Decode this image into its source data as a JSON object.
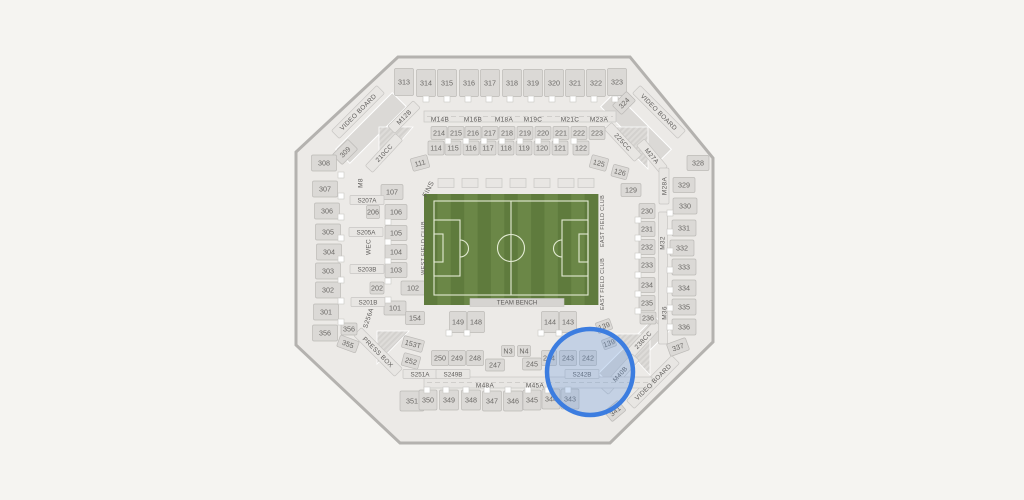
{
  "page": {
    "background": "#f5f4f1"
  },
  "stadium": {
    "octagon": "398,57 630,57 713,158 713,342 610,443 400,443 296,345 296,152",
    "colors": {
      "concourse": "#eceae7",
      "outline": "#b4b2af",
      "section": "#dbd9d6",
      "sectionStroke": "#bcbab7",
      "strip": "#e8e6e3",
      "stripStroke": "#c8c6c3",
      "label": "#6b6966",
      "stripLabel": "#5f5d5b",
      "marker": "#ffffff",
      "markerStroke": "#c9c7c4",
      "fieldLight": "#6b8747",
      "fieldDark": "#5f7b3d",
      "fieldLine": "#e3ebd3",
      "bench": "#d6d4d1",
      "ringBlue": "#3c7de0",
      "overlayBlue": "rgba(104,153,222,0.30)"
    },
    "field": {
      "x": 424,
      "y": 194,
      "w": 174,
      "h": 111,
      "stripes": 13,
      "bench_label": "TEAM BENCH",
      "bench": [
        470,
        298.5,
        94,
        8
      ]
    },
    "decor_bands": [
      [
        371,
        128,
        80,
        20,
        -45
      ],
      [
        636,
        128,
        80,
        20,
        45
      ],
      [
        634,
        352,
        80,
        20,
        -45
      ]
    ],
    "hatches": [
      "379,127 413,127 379,166",
      "606,127 648,127 648,169",
      "612,334 650,334 650,375",
      "377,331 409,331 377,364"
    ],
    "rot_bands": [
      [
        358,
        112,
        64,
        11,
        -45
      ],
      [
        659,
        112,
        64,
        11,
        45
      ],
      [
        653,
        382,
        64,
        11,
        -45
      ],
      [
        378,
        352,
        58,
        11,
        45
      ],
      [
        384,
        153,
        44,
        10,
        -47
      ],
      [
        623,
        142,
        44,
        10,
        47
      ],
      [
        643,
        340,
        44,
        10,
        -47
      ],
      [
        652,
        156,
        36,
        10,
        50
      ],
      [
        620,
        374,
        46,
        10,
        -48
      ],
      [
        404,
        117,
        36,
        10,
        -45
      ],
      [
        664,
        186,
        10,
        36,
        0
      ],
      [
        663,
        278,
        9,
        132,
        0
      ]
    ],
    "h_bands": [
      [
        424,
        111,
        192,
        11
      ],
      [
        424,
        377,
        228,
        11
      ]
    ],
    "suites": {
      "y": 183,
      "w": 16,
      "h": 9,
      "xs": [
        446,
        470,
        494,
        518,
        542,
        566,
        586
      ]
    },
    "sections": [
      [
        "313",
        404,
        82,
        19,
        27
      ],
      [
        "314",
        426,
        83,
        19,
        27
      ],
      [
        "315",
        447,
        83,
        19,
        27
      ],
      [
        "316",
        469,
        83,
        19,
        27
      ],
      [
        "317",
        490,
        83,
        19,
        27
      ],
      [
        "318",
        512,
        83,
        19,
        27
      ],
      [
        "319",
        533,
        83,
        19,
        27
      ],
      [
        "320",
        554,
        83,
        19,
        27
      ],
      [
        "321",
        575,
        83,
        19,
        27
      ],
      [
        "322",
        596,
        83,
        19,
        27
      ],
      [
        "323",
        617,
        82,
        19,
        27
      ],
      [
        "324",
        624,
        103,
        20,
        13,
        -45
      ],
      [
        "214",
        439,
        133,
        16,
        13
      ],
      [
        "215",
        456,
        133,
        16,
        13
      ],
      [
        "216",
        473,
        133,
        16,
        13
      ],
      [
        "217",
        490,
        133,
        16,
        13
      ],
      [
        "218",
        507,
        133,
        16,
        13
      ],
      [
        "219",
        525,
        133,
        16,
        13
      ],
      [
        "220",
        543,
        133,
        16,
        13
      ],
      [
        "221",
        561,
        133,
        16,
        13
      ],
      [
        "222",
        579,
        133,
        16,
        13
      ],
      [
        "223",
        597,
        133,
        16,
        13
      ],
      [
        "114",
        436,
        148,
        16,
        14
      ],
      [
        "115",
        453,
        148,
        16,
        14
      ],
      [
        "116",
        471,
        148,
        16,
        14
      ],
      [
        "117",
        488,
        148,
        16,
        14
      ],
      [
        "118",
        506,
        148,
        16,
        14
      ],
      [
        "119",
        524,
        148,
        16,
        14
      ],
      [
        "120",
        542,
        148,
        16,
        14
      ],
      [
        "121",
        560,
        148,
        16,
        14
      ],
      [
        "122",
        581,
        148,
        16,
        14
      ],
      [
        "111",
        420,
        163,
        17,
        13,
        -15
      ],
      [
        "125",
        599,
        163,
        17,
        13,
        15
      ],
      [
        "126",
        620,
        172,
        16,
        12,
        15
      ],
      [
        "129",
        631,
        190,
        20,
        13
      ],
      [
        "309",
        345,
        152,
        22,
        14,
        -45
      ],
      [
        "308",
        324,
        163,
        25,
        16
      ],
      [
        "307",
        325,
        189,
        25,
        16
      ],
      [
        "306",
        327,
        211,
        25,
        16
      ],
      [
        "305",
        328,
        232,
        25,
        16
      ],
      [
        "304",
        329,
        252,
        25,
        16
      ],
      [
        "303",
        328,
        271,
        25,
        16
      ],
      [
        "302",
        328,
        290,
        25,
        16
      ],
      [
        "301",
        326,
        312,
        25,
        16
      ],
      [
        "356",
        325,
        333,
        25,
        16
      ],
      [
        "356",
        349,
        329,
        16,
        12
      ],
      [
        "355",
        348,
        344,
        20,
        12,
        20
      ],
      [
        "107",
        392,
        192,
        22,
        15
      ],
      [
        "106",
        396,
        212,
        22,
        15
      ],
      [
        "105",
        396,
        233,
        22,
        15
      ],
      [
        "104",
        396,
        252,
        22,
        15
      ],
      [
        "103",
        396,
        270,
        22,
        15
      ],
      [
        "102",
        413,
        288,
        24,
        14
      ],
      [
        "101",
        395,
        308,
        22,
        14
      ],
      [
        "206",
        373,
        212,
        13,
        13
      ],
      [
        "202",
        377,
        288,
        14,
        12
      ],
      [
        "154",
        415,
        318,
        19,
        13
      ],
      [
        "153T",
        413,
        344,
        21,
        12,
        15
      ],
      [
        "149",
        458,
        322,
        17,
        21
      ],
      [
        "148",
        476,
        322,
        17,
        21
      ],
      [
        "144",
        550,
        322,
        17,
        21
      ],
      [
        "143",
        568,
        322,
        17,
        21
      ],
      [
        "139",
        604,
        326,
        15,
        11,
        -20
      ],
      [
        "139",
        609,
        343,
        13,
        10,
        -20
      ],
      [
        "252",
        411,
        361,
        17,
        13,
        15
      ],
      [
        "250",
        440,
        358,
        17,
        15
      ],
      [
        "249",
        457,
        358,
        17,
        15
      ],
      [
        "248",
        475,
        358,
        17,
        15
      ],
      [
        "247",
        495,
        365,
        19,
        12
      ],
      [
        "245",
        532,
        364,
        19,
        12
      ],
      [
        "244",
        549,
        358,
        15,
        15
      ],
      [
        "243",
        568,
        358,
        17,
        15
      ],
      [
        "242",
        588,
        358,
        17,
        15
      ],
      [
        "N3",
        508,
        351,
        13,
        11
      ],
      [
        "N4",
        524,
        351,
        13,
        11
      ],
      [
        "351",
        412,
        401,
        24,
        20
      ],
      [
        "350",
        428,
        400,
        18,
        20
      ],
      [
        "349",
        449,
        400,
        19,
        20
      ],
      [
        "348",
        471,
        400,
        19,
        20
      ],
      [
        "347",
        492,
        401,
        19,
        20
      ],
      [
        "346",
        513,
        401,
        19,
        20
      ],
      [
        "345",
        532,
        400,
        18,
        20
      ],
      [
        "344",
        551,
        399,
        18,
        20
      ],
      [
        "343",
        570,
        399,
        18,
        20
      ],
      [
        "341",
        615,
        411,
        18,
        13,
        -40
      ],
      [
        "328",
        698,
        163,
        22,
        15
      ],
      [
        "329",
        684,
        185,
        22,
        15
      ],
      [
        "330",
        685,
        206,
        24,
        16
      ],
      [
        "331",
        684,
        228,
        24,
        16
      ],
      [
        "332",
        682,
        248,
        24,
        16
      ],
      [
        "333",
        684,
        267,
        24,
        16
      ],
      [
        "334",
        684,
        288,
        24,
        16
      ],
      [
        "335",
        684,
        307,
        24,
        16
      ],
      [
        "336",
        684,
        327,
        24,
        16
      ],
      [
        "337",
        678,
        347,
        20,
        13,
        -20
      ],
      [
        "230",
        647,
        211,
        16,
        15
      ],
      [
        "231",
        647,
        229,
        16,
        15
      ],
      [
        "232",
        647,
        247,
        16,
        15
      ],
      [
        "233",
        647,
        265,
        16,
        15
      ],
      [
        "234",
        647,
        285,
        16,
        15
      ],
      [
        "235",
        647,
        303,
        16,
        15
      ],
      [
        "236",
        648,
        318,
        16,
        12
      ]
    ],
    "strips": [
      [
        "S207A",
        367,
        200,
        34,
        9
      ],
      [
        "S205A",
        366,
        232,
        34,
        9
      ],
      [
        "S203B",
        367,
        269,
        34,
        9
      ],
      [
        "S201B",
        368,
        302,
        34,
        9
      ],
      [
        "S251A",
        420,
        374,
        34,
        9
      ],
      [
        "S249B",
        453,
        374,
        34,
        9
      ],
      [
        "S242B",
        582,
        374,
        34,
        9
      ]
    ],
    "texts": [
      [
        "M14B",
        440,
        119,
        0,
        6.5
      ],
      [
        "M16B",
        473,
        119,
        0,
        6.5
      ],
      [
        "M18A",
        504,
        119,
        0,
        6.5
      ],
      [
        "M19C",
        533,
        119,
        0,
        6.5
      ],
      [
        "M21C",
        570,
        119,
        0,
        6.5
      ],
      [
        "M23A",
        599,
        119,
        0,
        6.5
      ],
      [
        "M48A",
        485,
        385,
        0,
        6.5
      ],
      [
        "M45A",
        535,
        385,
        0,
        6.5
      ],
      [
        "M12B",
        404,
        117,
        -45,
        6.5
      ],
      [
        "210CC",
        384,
        153,
        -47,
        6.5
      ],
      [
        "225CC",
        623,
        142,
        47,
        6.5
      ],
      [
        "M27A",
        652,
        156,
        50,
        6.5
      ],
      [
        "M28A",
        664,
        186,
        -90,
        6.5
      ],
      [
        "M32",
        662,
        243,
        -90,
        6.5
      ],
      [
        "M36",
        664,
        313,
        -90,
        6.5
      ],
      [
        "238CC",
        643,
        340,
        -47,
        6.5
      ],
      [
        "M40B",
        620,
        374,
        -48,
        6.5
      ],
      [
        "M8",
        360,
        183,
        -90,
        6.5
      ],
      [
        "WEC",
        368,
        247,
        -90,
        6.5
      ],
      [
        "S256A",
        368,
        318,
        -72,
        6.5
      ],
      [
        "FINS",
        428,
        189,
        -62,
        7
      ],
      [
        "WEST FIELD CLUB",
        423,
        248,
        -90,
        5.5
      ],
      [
        "EAST FIELD CLUB",
        602,
        221,
        -90,
        5.5
      ],
      [
        "EAST FIELD CLUB",
        602,
        284,
        -90,
        5.5
      ],
      [
        "VIDEO BOARD",
        358,
        112,
        -45,
        6.5
      ],
      [
        "VIDEO BOARD",
        659,
        112,
        45,
        6.5
      ],
      [
        "VIDEO BOARD",
        653,
        382,
        -45,
        6.5
      ],
      [
        "PRESS BOX",
        378,
        352,
        45,
        6.5
      ]
    ],
    "markers": [
      [
        426,
        99
      ],
      [
        447,
        99
      ],
      [
        468,
        99
      ],
      [
        489,
        99
      ],
      [
        510,
        99
      ],
      [
        531,
        99
      ],
      [
        552,
        99
      ],
      [
        573,
        99
      ],
      [
        594,
        99
      ],
      [
        615,
        99
      ],
      [
        448,
        141
      ],
      [
        466,
        141
      ],
      [
        484,
        141
      ],
      [
        502,
        141
      ],
      [
        520,
        141
      ],
      [
        538,
        141
      ],
      [
        556,
        141
      ],
      [
        574,
        141
      ],
      [
        341,
        175
      ],
      [
        341,
        196
      ],
      [
        341,
        217
      ],
      [
        341,
        238
      ],
      [
        341,
        259
      ],
      [
        341,
        280
      ],
      [
        341,
        301
      ],
      [
        341,
        322
      ],
      [
        670,
        213
      ],
      [
        670,
        232
      ],
      [
        670,
        251
      ],
      [
        670,
        270
      ],
      [
        670,
        290
      ],
      [
        670,
        308
      ],
      [
        670,
        327
      ],
      [
        427,
        390
      ],
      [
        446,
        390
      ],
      [
        466,
        390
      ],
      [
        487,
        390
      ],
      [
        508,
        390
      ],
      [
        528,
        390
      ],
      [
        548,
        390
      ],
      [
        568,
        390
      ],
      [
        449,
        333
      ],
      [
        467,
        333
      ],
      [
        541,
        333
      ],
      [
        559,
        333
      ],
      [
        388,
        222
      ],
      [
        388,
        242
      ],
      [
        388,
        261
      ],
      [
        388,
        281
      ],
      [
        388,
        300
      ],
      [
        638,
        220
      ],
      [
        638,
        238
      ],
      [
        638,
        256
      ],
      [
        638,
        275
      ],
      [
        638,
        294
      ],
      [
        638,
        311
      ]
    ],
    "highlight": {
      "cx": 590,
      "cy": 372,
      "r": 43
    }
  }
}
